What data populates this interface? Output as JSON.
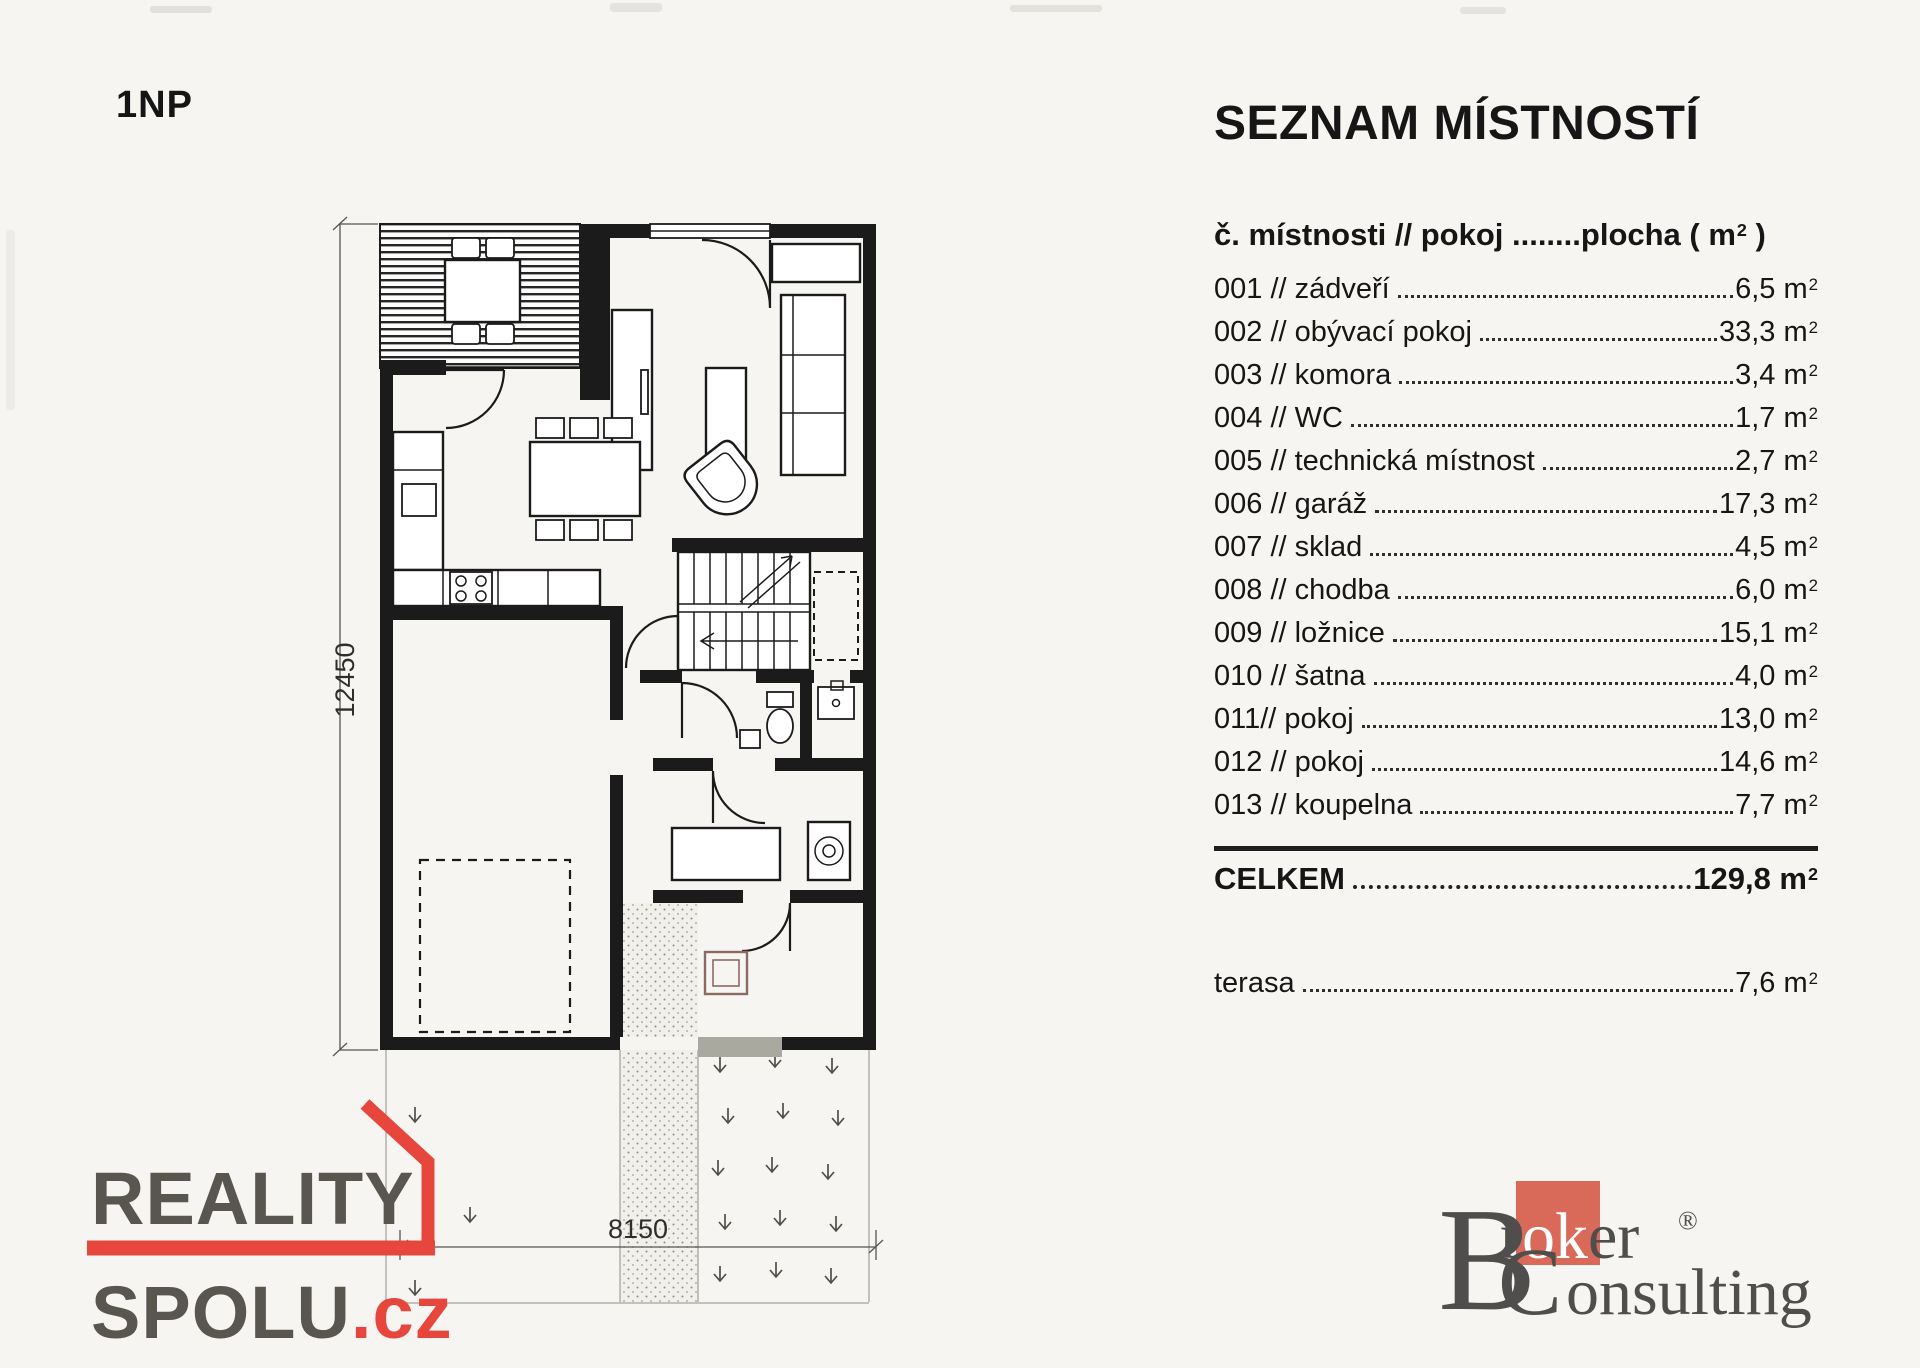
{
  "theme": {
    "paper": "#f6f5f1",
    "ink": "#1b1b1b",
    "dimc": "#555555",
    "logo_gray": "#59554f",
    "logo_red": "#e6463c",
    "broker_gray": "#4f4e4c",
    "broker_red": "#d96a5a",
    "mat": "#a9a9a0"
  },
  "plan": {
    "floor_label": "1NP",
    "dim_vertical": "12450",
    "dim_horizontal": "8150"
  },
  "room_list": {
    "title": "SEZNAM MÍSTNOSTÍ",
    "header": {
      "left": "č. místnosti // pokoj ",
      "dots": "........",
      "right_pre": "plocha ( m",
      "exp": "2",
      "right_post": " )"
    },
    "unit_base": " m",
    "unit_exp": "2",
    "rooms": [
      {
        "label": "001 // zádveří",
        "area": "6,5"
      },
      {
        "label": "002 // obývací pokoj",
        "area": "33,3"
      },
      {
        "label": "003 // komora",
        "area": "3,4"
      },
      {
        "label": "004 // WC",
        "area": "1,7"
      },
      {
        "label": "005 // technická místnost",
        "area": "2,7"
      },
      {
        "label": "006 // garáž",
        "area": "17,3"
      },
      {
        "label": "007 // sklad",
        "area": "4,5"
      },
      {
        "label": "008 // chodba",
        "area": "6,0"
      },
      {
        "label": "009 // ložnice",
        "area": "15,1"
      },
      {
        "label": "010 // šatna",
        "area": "4,0"
      },
      {
        "label": "011// pokoj",
        "area": "13,0"
      },
      {
        "label": "012 // pokoj",
        "area": "14,6"
      },
      {
        "label": "013 // koupelna",
        "area": "7,7"
      }
    ],
    "total": {
      "label": "CELKEM",
      "area": "129,8"
    },
    "terrace": {
      "label": "terasa",
      "area": "7,6"
    }
  },
  "logos": {
    "realityspolu": {
      "line1": "REALITY",
      "line2": "SPOLU",
      "tld": ".cz"
    },
    "broker": {
      "b": "B",
      "r": "r",
      "ok": "ok",
      "er": "er",
      "reg": "®",
      "c": "C",
      "onsulting": "onsulting"
    }
  }
}
